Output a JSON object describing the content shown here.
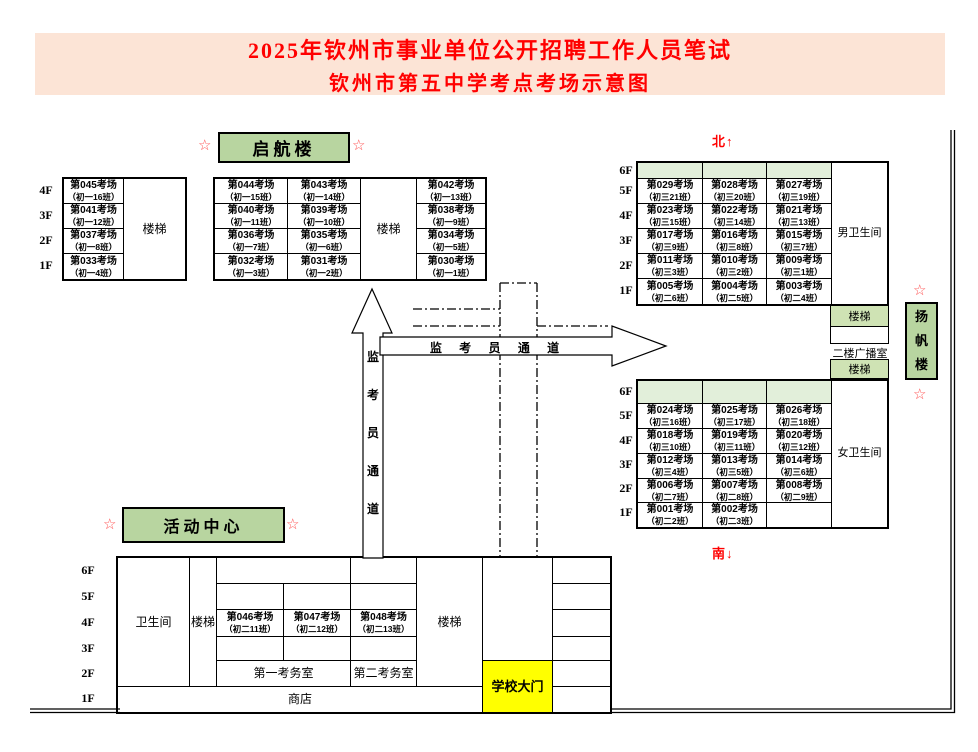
{
  "title": {
    "line1": "2025年钦州市事业单位公开招聘工作人员笔试",
    "line2": "钦州市第五中学考点考场示意图"
  },
  "compass": {
    "north": "北↑",
    "south": "南↓"
  },
  "star": "☆",
  "common": {
    "stairs": "楼梯",
    "restroom": "卫生间",
    "male_restroom": "男卫生间",
    "female_restroom": "女卫生间",
    "broadcast": "二楼广播室",
    "office1": "第一考务室",
    "office2": "第二考务室",
    "shop": "商店",
    "gate": "学校大门"
  },
  "passage": {
    "vertical": "监\n考\n员\n通\n道",
    "horizontal": "监 考 员 通 道"
  },
  "qihang": {
    "name": "启航楼",
    "left": {
      "floors": [
        "4F",
        "3F",
        "2F",
        "1F"
      ],
      "rooms": [
        {
          "room": "第045考场",
          "cls": "（初一16班）"
        },
        {
          "room": "第041考场",
          "cls": "（初一12班）"
        },
        {
          "room": "第037考场",
          "cls": "（初一8班）"
        },
        {
          "room": "第033考场",
          "cls": "（初一4班）"
        }
      ]
    },
    "main": {
      "rows": [
        [
          {
            "room": "第044考场",
            "cls": "（初一15班）"
          },
          {
            "room": "第043考场",
            "cls": "（初一14班）"
          },
          {
            "room": "第042考场",
            "cls": "（初一13班）"
          }
        ],
        [
          {
            "room": "第040考场",
            "cls": "（初一11班）"
          },
          {
            "room": "第039考场",
            "cls": "（初一10班）"
          },
          {
            "room": "第038考场",
            "cls": "（初一9班）"
          }
        ],
        [
          {
            "room": "第036考场",
            "cls": "（初一7班）"
          },
          {
            "room": "第035考场",
            "cls": "（初一6班）"
          },
          {
            "room": "第034考场",
            "cls": "（初一5班）"
          }
        ],
        [
          {
            "room": "第032考场",
            "cls": "（初一3班）"
          },
          {
            "room": "第031考场",
            "cls": "（初一2班）"
          },
          {
            "room": "第030考场",
            "cls": "（初一1班）"
          }
        ]
      ]
    }
  },
  "yangfan": {
    "name_vertical": "扬\n帆\n楼",
    "north_block": {
      "floors": [
        "6F",
        "5F",
        "4F",
        "3F",
        "2F",
        "1F"
      ],
      "rows": [
        [
          {
            "room": "第029考场",
            "cls": "（初三21班）"
          },
          {
            "room": "第028考场",
            "cls": "（初三20班）"
          },
          {
            "room": "第027考场",
            "cls": "（初三19班）"
          }
        ],
        [
          {
            "room": "第023考场",
            "cls": "（初三15班）"
          },
          {
            "room": "第022考场",
            "cls": "（初三14班）"
          },
          {
            "room": "第021考场",
            "cls": "（初三13班）"
          }
        ],
        [
          {
            "room": "第017考场",
            "cls": "（初三9班）"
          },
          {
            "room": "第016考场",
            "cls": "（初三8班）"
          },
          {
            "room": "第015考场",
            "cls": "（初三7班）"
          }
        ],
        [
          {
            "room": "第011考场",
            "cls": "（初三3班）"
          },
          {
            "room": "第010考场",
            "cls": "（初三2班）"
          },
          {
            "room": "第009考场",
            "cls": "（初三1班）"
          }
        ],
        [
          {
            "room": "第005考场",
            "cls": "（初二6班）"
          },
          {
            "room": "第004考场",
            "cls": "（初二5班）"
          },
          {
            "room": "第003考场",
            "cls": "（初二4班）"
          }
        ]
      ]
    },
    "south_block": {
      "floors": [
        "6F",
        "5F",
        "4F",
        "3F",
        "2F",
        "1F"
      ],
      "rows": [
        [
          {
            "room": "第024考场",
            "cls": "（初三16班）"
          },
          {
            "room": "第025考场",
            "cls": "（初三17班）"
          },
          {
            "room": "第026考场",
            "cls": "（初三18班）"
          }
        ],
        [
          {
            "room": "第018考场",
            "cls": "（初三10班）"
          },
          {
            "room": "第019考场",
            "cls": "（初三11班）"
          },
          {
            "room": "第020考场",
            "cls": "（初三12班）"
          }
        ],
        [
          {
            "room": "第012考场",
            "cls": "（初三4班）"
          },
          {
            "room": "第013考场",
            "cls": "（初三5班）"
          },
          {
            "room": "第014考场",
            "cls": "（初三6班）"
          }
        ],
        [
          {
            "room": "第006考场",
            "cls": "（初二7班）"
          },
          {
            "room": "第007考场",
            "cls": "（初二8班）"
          },
          {
            "room": "第008考场",
            "cls": "（初二9班）"
          }
        ],
        [
          {
            "room": "第001考场",
            "cls": "（初二2班）"
          },
          {
            "room": "第002考场",
            "cls": "（初二3班）"
          }
        ]
      ]
    }
  },
  "activity": {
    "name": "活动中心",
    "floors": [
      "6F",
      "5F",
      "4F",
      "3F",
      "2F",
      "1F"
    ],
    "rooms": [
      {
        "room": "第046考场",
        "cls": "（初二11班）"
      },
      {
        "room": "第047考场",
        "cls": "（初二12班）"
      },
      {
        "room": "第048考场",
        "cls": "（初二13班）"
      }
    ]
  }
}
